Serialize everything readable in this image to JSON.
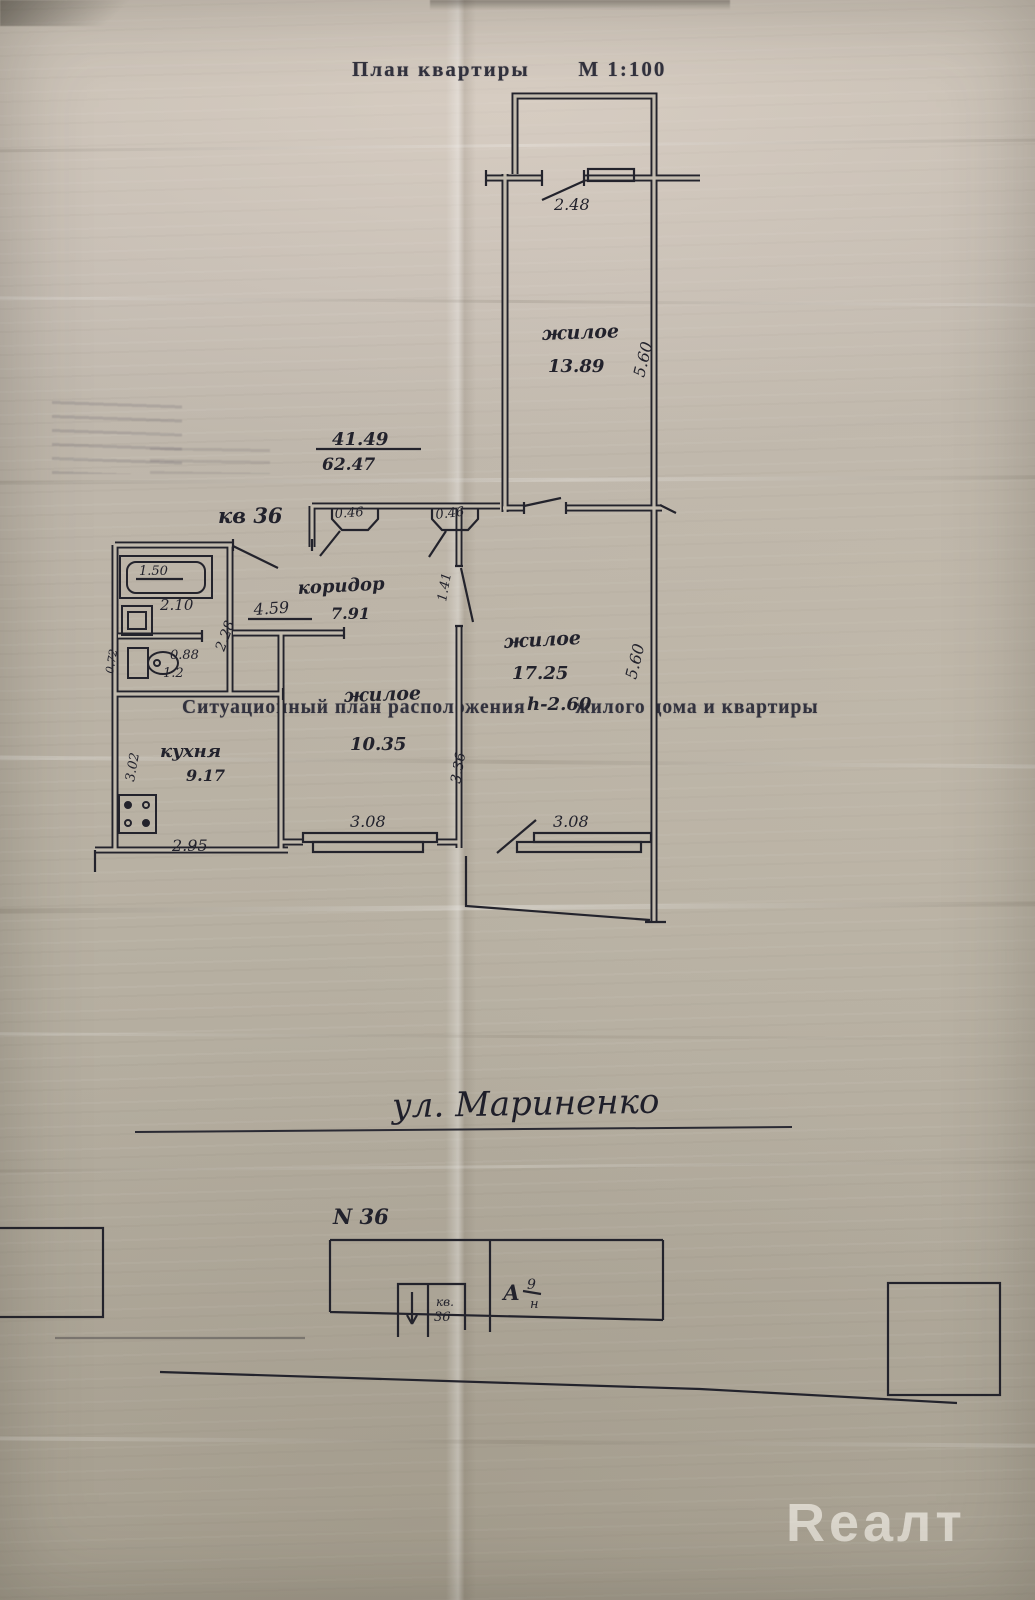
{
  "page": {
    "title": "План квартиры",
    "scale_label": "М  1:100",
    "situational_caption_a": "Ситуационный план расположения",
    "situational_caption_b": "жилого дома и квартиры",
    "watermark": "Reaлт"
  },
  "plan": {
    "apartment_label": "кв 36",
    "area_fraction_top": "41.49",
    "area_fraction_bottom": "62.47",
    "rooms": {
      "top": {
        "name": "жилое",
        "area": "13.89"
      },
      "right": {
        "name": "жилое",
        "area": "17.25",
        "height_note": "h-2.60"
      },
      "middle": {
        "name": "жилое",
        "area": "10.35"
      },
      "kitchen": {
        "name": "кухня",
        "area": "9.17"
      },
      "corridor": {
        "name": "коридор",
        "area": "7.91"
      }
    },
    "dims": {
      "balcony_width": "2.48",
      "top_room_depth": "5.60",
      "right_room_depth": "5.60",
      "closet_a": "0.46",
      "closet_b": "0.46",
      "corridor_w": "1.41",
      "hall_len": "4.59",
      "bath_depth": "2.28",
      "bath_len": "2.10",
      "tub_len": "1.50",
      "wc_w": "0.88",
      "wc_len": "1.2",
      "wc_side": "0.72",
      "kitchen_w": "3.02",
      "mid_room_w": "3.36",
      "window_a": "3.08",
      "window_b": "3.08",
      "kitchen_len": "2.95"
    }
  },
  "site": {
    "street_label": "ул. Мариненко",
    "house_label": "N 36",
    "apt_box_line1": "кв.",
    "apt_box_line2": "36",
    "building_letter": "А",
    "building_fraction_top": "9",
    "building_fraction_bottom": "н"
  }
}
